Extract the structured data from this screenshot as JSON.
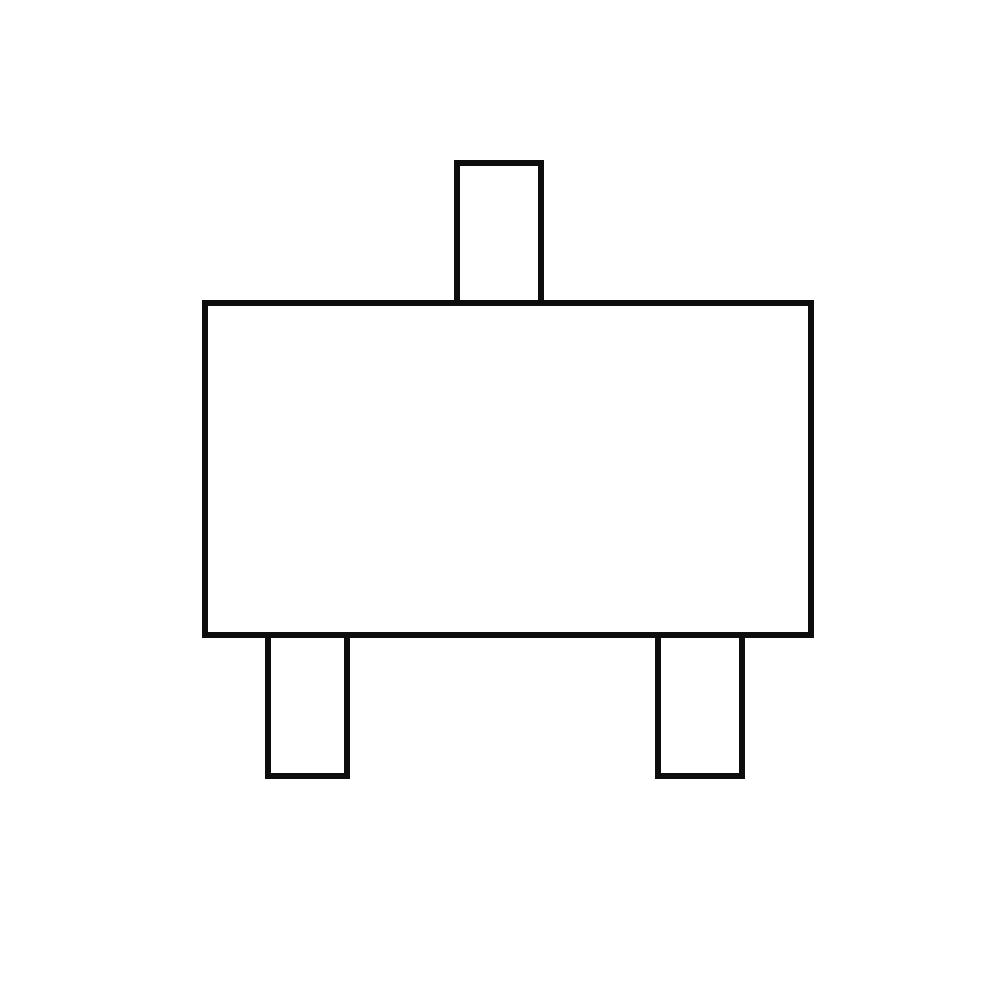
{
  "canvas": {
    "width": 1000,
    "height": 1000,
    "background": "#ffffff"
  },
  "diagram": {
    "name": "sot23-package-outline",
    "description_label": "",
    "stroke_color": "#0d0d0d",
    "stroke_width": 6,
    "fill": "#ffffff",
    "shapes": [
      {
        "name": "package-body",
        "x": 205,
        "y": 303,
        "width": 606,
        "height": 332
      },
      {
        "name": "top-lead",
        "x": 457,
        "y": 163,
        "width": 84,
        "height": 140
      },
      {
        "name": "bottom-left-lead",
        "x": 268,
        "y": 635,
        "width": 79,
        "height": 141
      },
      {
        "name": "bottom-right-lead",
        "x": 658,
        "y": 635,
        "width": 84,
        "height": 141
      }
    ]
  }
}
